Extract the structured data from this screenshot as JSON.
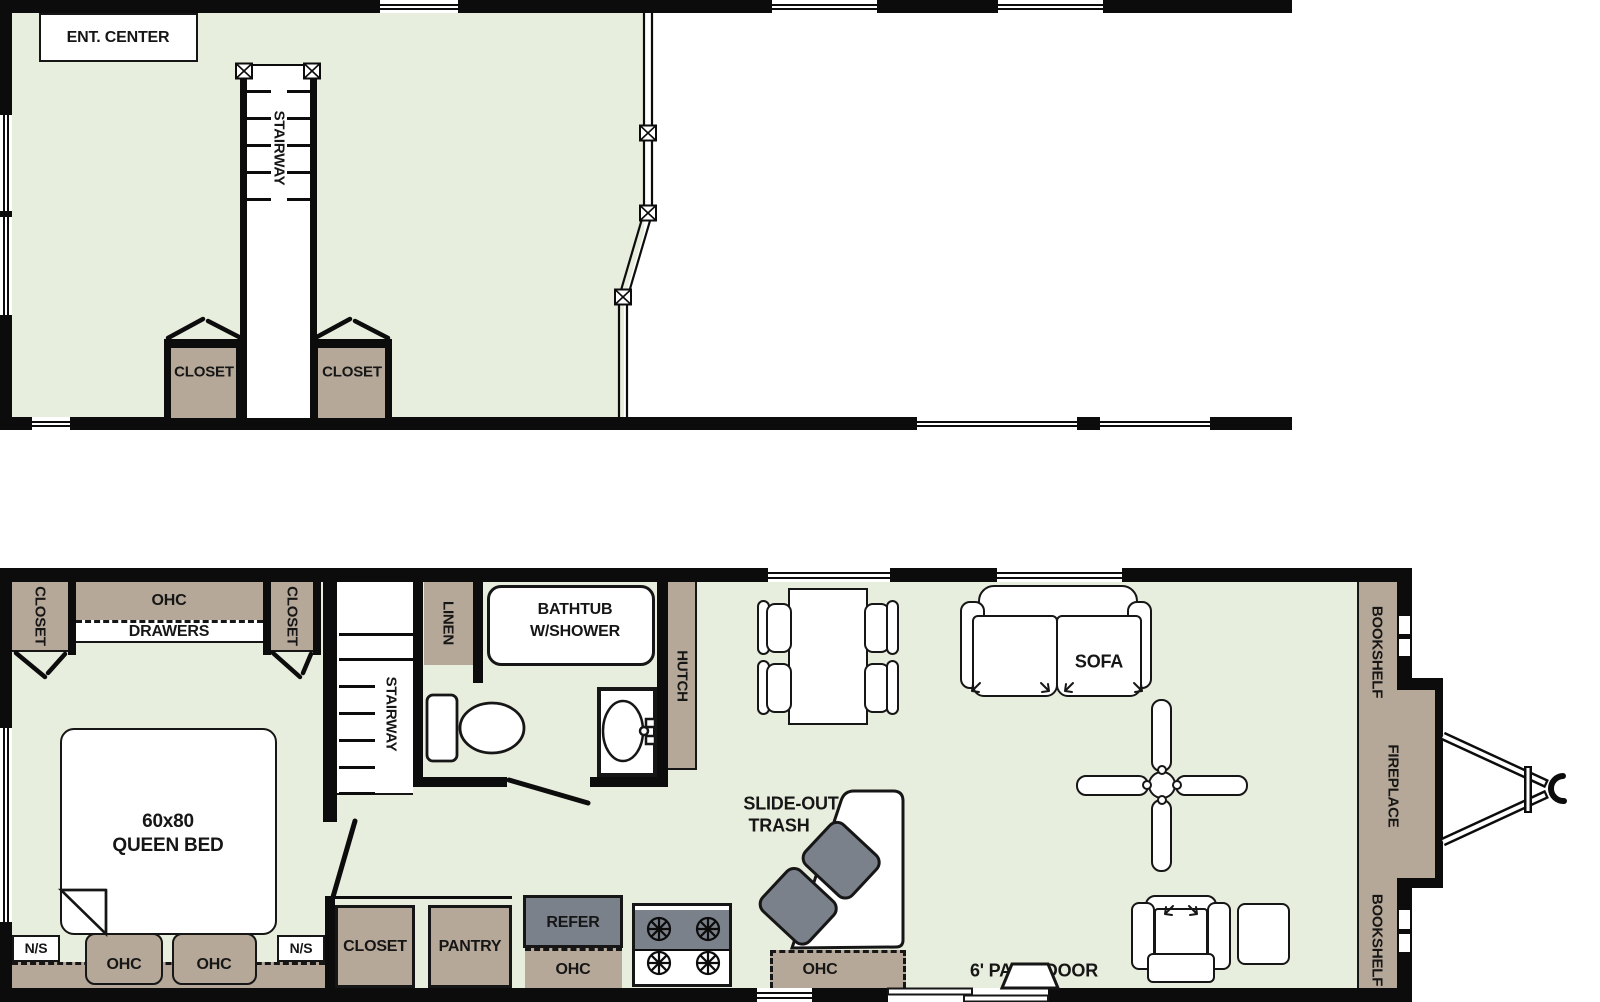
{
  "colors": {
    "floor": "#e8eedd",
    "cabinet": "#b5a898",
    "appliance_gray": "#7b818b",
    "wall": "#0c0c0c",
    "line": "#161616"
  },
  "upper": {
    "ent_center": "ENT. CENTER",
    "stairway": "STAIRWAY",
    "closet_left": "CLOSET",
    "closet_right": "CLOSET"
  },
  "bedroom": {
    "closet_left": "CLOSET",
    "ohc": "OHC",
    "drawers": "DRAWERS",
    "closet_right": "CLOSET",
    "bed_size": "60x80",
    "bed_type": "QUEEN BED",
    "ns_left": "N/S",
    "ns_right": "N/S",
    "ohc_left": "OHC",
    "ohc_right": "OHC"
  },
  "hall": {
    "stairway": "STAIRWAY",
    "closet": "CLOSET",
    "pantry": "PANTRY"
  },
  "bath": {
    "linen": "LINEN",
    "tub_line1": "BATHTUB",
    "tub_line2": "W/SHOWER"
  },
  "kitchen": {
    "hutch": "HUTCH",
    "refer": "REFER",
    "ohc_under_refer": "OHC",
    "ohc_counter": "OHC",
    "trash_line1": "SLIDE-OUT",
    "trash_line2": "TRASH"
  },
  "living": {
    "sofa": "SOFA",
    "patio_door": "6' PATIO DOOR",
    "bookshelf_top": "BOOKSHELF",
    "fireplace": "FIREPLACE",
    "bookshelf_bottom": "BOOKSHELF"
  }
}
